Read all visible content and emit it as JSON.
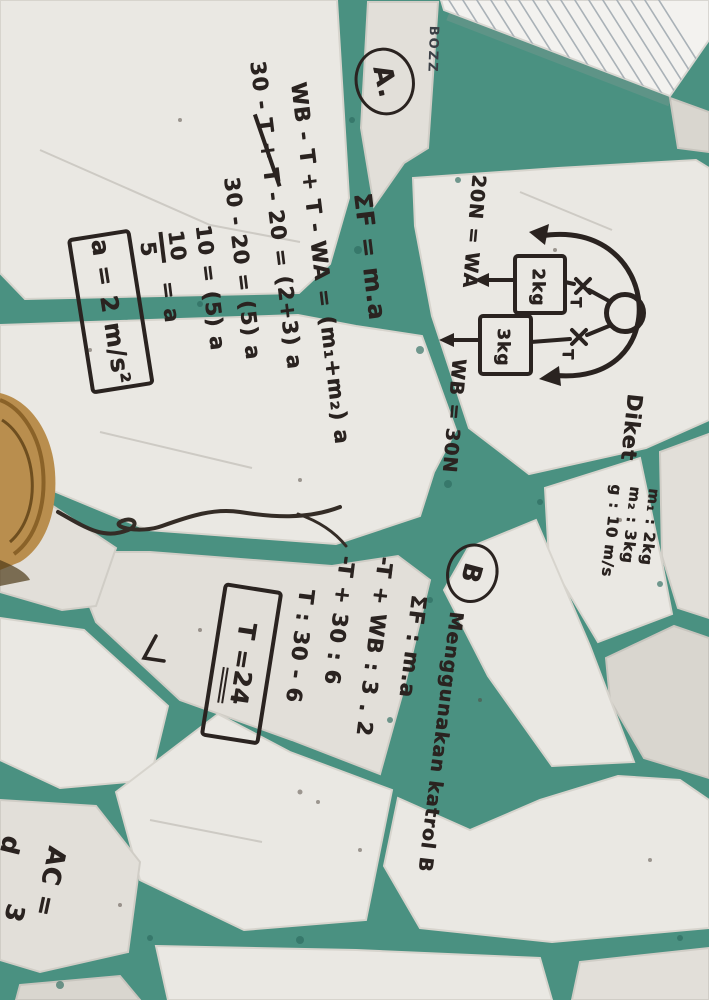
{
  "colors": {
    "grout": "#4a9181",
    "tile": "#e9e7e2",
    "marker": "#2a2320",
    "wood": "#b98e4e"
  },
  "notepad": {
    "brand": "BOZZ"
  },
  "work": {
    "section_a": {
      "label": "A.",
      "l1": "ΣF = m.a",
      "l2": "WB - T + T - WA = (m₁+m₂) a",
      "l3_pre": "30 - ",
      "l3_strike": "T + T",
      "l3_post": " - 20 = (2+3) a",
      "l4": "30 - 20 = (5) a",
      "l5": "10 = (5) a",
      "frac_num": "10",
      "frac_den": "5",
      "frac_rhs": "= a",
      "answer": "a = 2 m/s²"
    },
    "section_b": {
      "label": "B",
      "title": "Menggunakan katrol B",
      "l1": "ΣF : m.a",
      "l2": "-T + WB : 3 . 2",
      "l3": "-T + 30 : 6",
      "l4": "T : 30 - 6",
      "ans_prefix": "T = ",
      "ans_value": "24"
    },
    "known": {
      "heading": "Diket",
      "m1": "m₁ : 2kg",
      "m2": "m₂ : 3kg",
      "g": "g : 10 m/s"
    },
    "diagram": {
      "mass_left": "2kg",
      "mass_right": "3kg",
      "t_left": "T",
      "t_right": "T",
      "w_left": "20N = WA",
      "w_right": "WB = 30N"
    },
    "corner": {
      "ac": "AC =",
      "three": "3",
      "d": "d"
    }
  }
}
